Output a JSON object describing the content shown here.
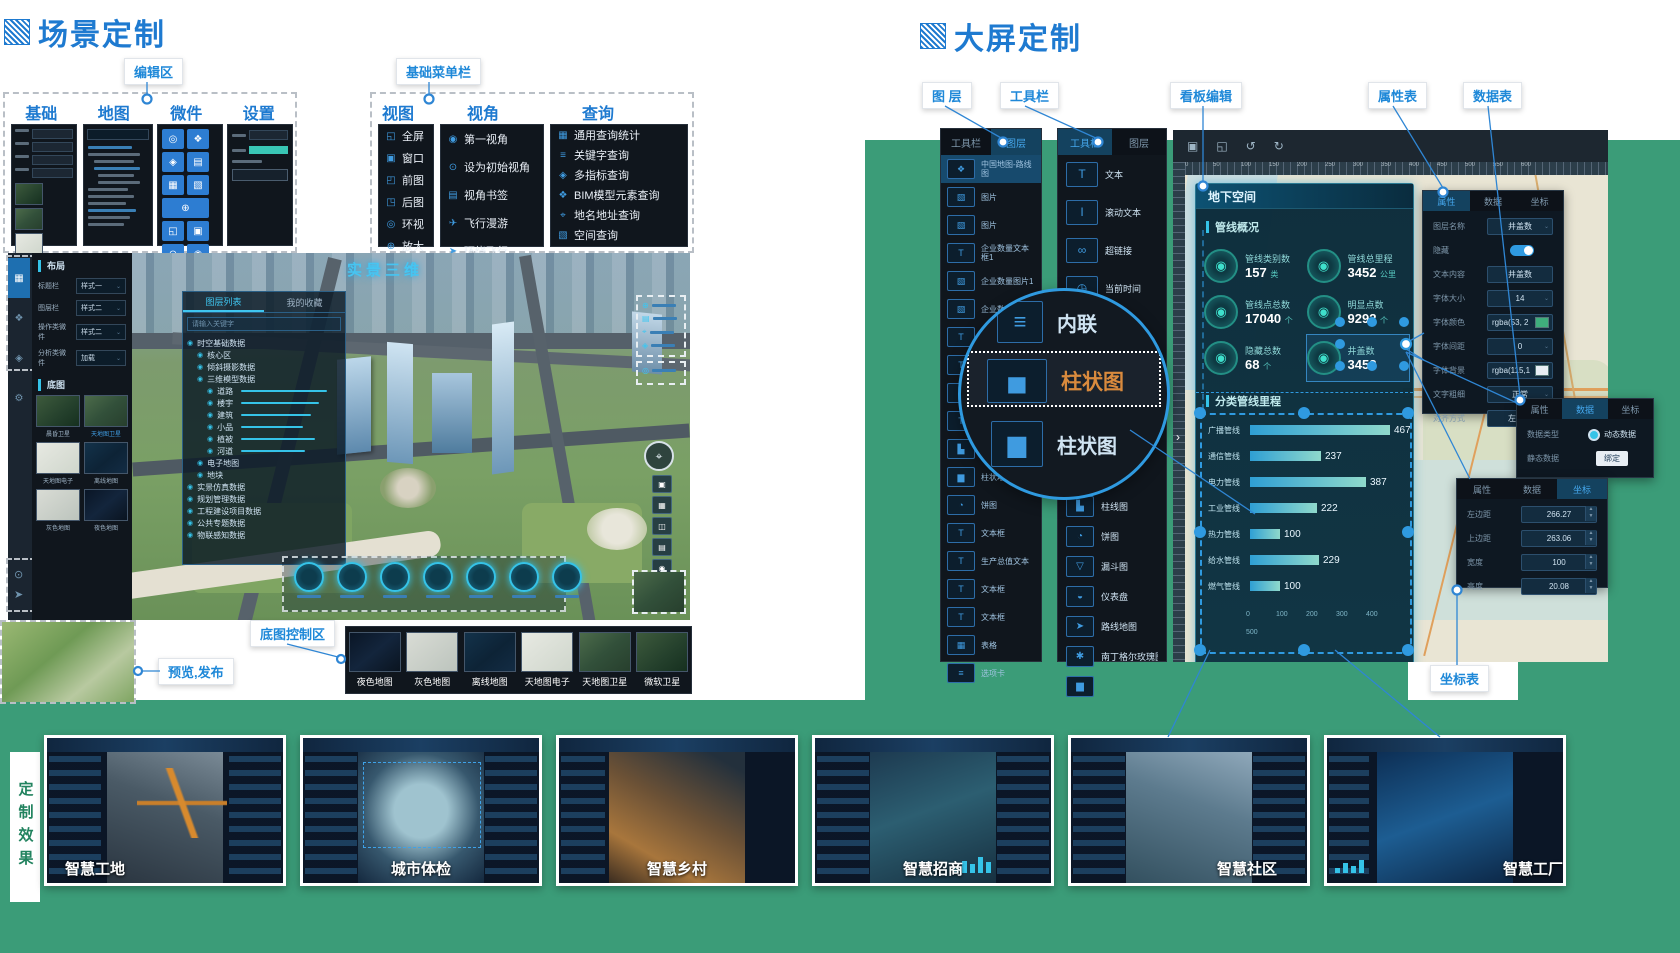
{
  "scene": {
    "title": "场景定制",
    "annotations": {
      "editor": "编辑区",
      "menu": "基础菜单栏",
      "preview": "预览,发布",
      "basemap": "底图控制区"
    },
    "panel_tabs": [
      "基础",
      "地图",
      "微件",
      "设置"
    ],
    "menu_groups": [
      {
        "title": "视图",
        "items": [
          {
            "icon": "fullscreen-icon",
            "label": "全屏"
          },
          {
            "icon": "window-icon",
            "label": "窗口"
          },
          {
            "icon": "prev-view-icon",
            "label": "前图"
          },
          {
            "icon": "next-view-icon",
            "label": "后图"
          },
          {
            "icon": "orbit-icon",
            "label": "环视"
          },
          {
            "icon": "zoom-in-icon",
            "label": "放大"
          },
          {
            "icon": "",
            "label": "⋯"
          }
        ]
      },
      {
        "title": "视角",
        "items": [
          {
            "icon": "first-person-icon",
            "label": "第一视角"
          },
          {
            "icon": "initial-view-icon",
            "label": "设为初始视角"
          },
          {
            "icon": "bookmark-icon",
            "label": "视角书签"
          },
          {
            "icon": "flight-roam-icon",
            "label": "飞行漫游"
          },
          {
            "icon": "orbit-flight-icon",
            "label": "环绕飞行"
          }
        ]
      },
      {
        "title": "查询",
        "items": [
          {
            "icon": "stats-query-icon",
            "label": "通用查询统计"
          },
          {
            "icon": "keyword-query-icon",
            "label": "关键字查询"
          },
          {
            "icon": "multi-indicator-icon",
            "label": "多指标查询"
          },
          {
            "icon": "bim-query-icon",
            "label": "BIM模型元素查询"
          },
          {
            "icon": "address-query-icon",
            "label": "地名地址查询"
          },
          {
            "icon": "spatial-query-icon",
            "label": "空间查询"
          },
          {
            "icon": "",
            "label": "⋯"
          }
        ]
      }
    ],
    "layout_header": "布局",
    "layout_rows": [
      {
        "label": "标题栏",
        "value": "样式一"
      },
      {
        "label": "图层栏",
        "value": "样式二"
      },
      {
        "label": "操作类微件",
        "value": "样式二"
      },
      {
        "label": "分析类微件",
        "value": "加载"
      }
    ],
    "basemap_header": "底图",
    "basemap_thumbs": [
      {
        "label": "晨昏卫星"
      },
      {
        "label": "天地图卫星",
        "active": true
      },
      {
        "label": "天地图电子"
      },
      {
        "label": "离线地图"
      },
      {
        "label": "灰色地图"
      },
      {
        "label": "夜色地图"
      }
    ],
    "tree_tabs": [
      "图层列表",
      "我的收藏"
    ],
    "tree_search_placeholder": "请输入关键字",
    "tree": [
      {
        "lv": 0,
        "label": "时空基础数据"
      },
      {
        "lv": 1,
        "label": "核心区"
      },
      {
        "lv": 1,
        "label": "倾斜摄影数据"
      },
      {
        "lv": 1,
        "label": "三维模型数据"
      },
      {
        "lv": 2,
        "label": "道路",
        "slider": 86
      },
      {
        "lv": 2,
        "label": "楼宇",
        "slider": 78
      },
      {
        "lv": 2,
        "label": "建筑",
        "slider": 70
      },
      {
        "lv": 2,
        "label": "小品",
        "slider": 62
      },
      {
        "lv": 2,
        "label": "植被",
        "slider": 74
      },
      {
        "lv": 2,
        "label": "河道",
        "slider": 64
      },
      {
        "lv": 1,
        "label": "电子地图"
      },
      {
        "lv": 1,
        "label": "地块"
      },
      {
        "lv": 0,
        "label": "实景仿真数据"
      },
      {
        "lv": 0,
        "label": "规划管理数据"
      },
      {
        "lv": 0,
        "label": "工程建设项目数据"
      },
      {
        "lv": 0,
        "label": "公共专题数据"
      },
      {
        "lv": 0,
        "label": "物联感知数据"
      }
    ],
    "watermark": "实景三维",
    "basemap_bar": [
      {
        "label": "夜色地图"
      },
      {
        "label": "灰色地图"
      },
      {
        "label": "离线地图"
      },
      {
        "label": "天地图电子"
      },
      {
        "label": "天地图卫星"
      },
      {
        "label": "微软卫星"
      }
    ]
  },
  "screen": {
    "title": "大屏定制",
    "annotations": {
      "layers": "图 层",
      "toolbar": "工具栏",
      "board": "看板编辑",
      "props": "属性表",
      "data": "数据表",
      "coords": "坐标表"
    },
    "panel_tabs": [
      "工具栏",
      "图层"
    ],
    "layers": [
      {
        "icon": "map-icon",
        "label": "中国地图-路线图",
        "active": true
      },
      {
        "icon": "image-icon",
        "label": "图片"
      },
      {
        "icon": "image-icon",
        "label": "图片"
      },
      {
        "icon": "text-icon",
        "label": "企业数量文本框1"
      },
      {
        "icon": "image-icon",
        "label": "企业数量图片1"
      },
      {
        "icon": "image-icon",
        "label": "企业数量图片2"
      },
      {
        "icon": "text-icon",
        "label": "企业数量文本"
      },
      {
        "icon": "text-icon",
        "label": "企业数量文本框4"
      },
      {
        "icon": "text-icon",
        "label": "企业数量文本"
      },
      {
        "icon": "text-icon",
        "label": "企业数量文本3"
      },
      {
        "icon": "chart-line-icon",
        "label": "生产柱线图"
      },
      {
        "icon": "bars-icon",
        "label": "柱状堆叠图"
      },
      {
        "icon": "pie-icon",
        "label": "饼图"
      },
      {
        "icon": "text-icon",
        "label": "文本框"
      },
      {
        "icon": "text-icon",
        "label": "生产总值文本"
      },
      {
        "icon": "text-icon",
        "label": "文本框"
      },
      {
        "icon": "text-icon",
        "label": "文本框"
      },
      {
        "icon": "table-icon",
        "label": "表格"
      },
      {
        "icon": "tab-card-icon",
        "label": "选项卡"
      }
    ],
    "tools_top": [
      {
        "icon": "text-icon",
        "label": "文本"
      },
      {
        "icon": "scroll-text-icon",
        "label": "滚动文本"
      },
      {
        "icon": "hyperlink-icon",
        "label": "超链接"
      },
      {
        "icon": "time-icon",
        "label": "当前时间"
      },
      {
        "icon": "image-icon",
        "label": "图片"
      },
      {
        "icon": "video-icon",
        "label": "视频"
      }
    ],
    "tools_bottom": [
      {
        "icon": "chart-line-icon",
        "label": "柱线图"
      },
      {
        "icon": "pie-icon",
        "label": "饼图"
      },
      {
        "icon": "funnel-icon",
        "label": "漏斗图"
      },
      {
        "icon": "gauge-icon",
        "label": "仪表盘"
      },
      {
        "icon": "route-map-icon",
        "label": "路线地图"
      },
      {
        "icon": "rose-icon",
        "label": "南丁格尔玫瑰图"
      },
      {
        "icon": "bars-icon",
        "label": ""
      }
    ],
    "magnifier_items": [
      {
        "icon": "list-icon",
        "label": "内联"
      },
      {
        "icon": "bar-chart-icon",
        "label": "柱状图",
        "selected": true
      },
      {
        "icon": "bars-icon",
        "label": "柱状图"
      }
    ],
    "ruler": [
      "0",
      "50",
      "100",
      "150",
      "200",
      "250",
      "300",
      "350",
      "400",
      "450",
      "500",
      "550",
      "600"
    ],
    "dashboard": {
      "title": "地下空间",
      "section1": "管线概况",
      "stats": [
        {
          "label": "管线类别数",
          "value": "157",
          "unit": "类"
        },
        {
          "label": "管线点总数",
          "value": "17040",
          "unit": "个"
        },
        {
          "label": "隐藏总数",
          "value": "68",
          "unit": "个"
        },
        {
          "label": "管线总里程",
          "value": "3452",
          "unit": "公里"
        },
        {
          "label": "明显点数",
          "value": "9292",
          "unit": "个"
        },
        {
          "label": "井盖数",
          "value": "3452",
          "unit": "",
          "selected": true
        }
      ]
    },
    "props": {
      "tabs": [
        "属性",
        "数据",
        "坐标"
      ],
      "active_tab": "属性",
      "rows": [
        {
          "label": "图层名称",
          "value": "井盖数",
          "type": "select"
        },
        {
          "label": "隐藏",
          "value": "",
          "type": "toggle"
        },
        {
          "label": "文本内容",
          "value": "井盖数",
          "type": "input"
        },
        {
          "label": "字体大小",
          "value": "14",
          "type": "select"
        },
        {
          "label": "字体颜色",
          "value": "rgba(53, 2",
          "type": "color",
          "swatch": "#3fae7c"
        },
        {
          "label": "字体间距",
          "value": "0",
          "type": "select"
        },
        {
          "label": "字体背景",
          "value": "rgba(115,1",
          "type": "color",
          "swatch": "#e8eef4"
        },
        {
          "label": "文字粗细",
          "value": "正常",
          "type": "select"
        },
        {
          "label": "对齐方式",
          "value": "左对齐",
          "type": "select"
        }
      ]
    },
    "data_panel": {
      "tabs": [
        "属性",
        "数据",
        "坐标"
      ],
      "active_tab": "数据",
      "rows": [
        {
          "label": "数据类型",
          "value": "动态数据",
          "type": "radio"
        },
        {
          "label": "静态数据",
          "value": "绑定",
          "type": "button"
        }
      ]
    },
    "coords_panel": {
      "tabs": [
        "属性",
        "数据",
        "坐标"
      ],
      "active_tab": "坐标",
      "rows": [
        {
          "label": "左边距",
          "value": "266.27",
          "type": "num"
        },
        {
          "label": "上边距",
          "value": "263.06",
          "type": "num"
        },
        {
          "label": "宽度",
          "value": "100",
          "type": "num"
        },
        {
          "label": "高度",
          "value": "20.08",
          "type": "num"
        }
      ]
    }
  },
  "chart_data": {
    "type": "bar",
    "orientation": "horizontal",
    "title": "分类管线里程",
    "categories": [
      "广播管线",
      "通信管线",
      "电力管线",
      "工业管线",
      "热力管线",
      "给水管线",
      "燃气管线"
    ],
    "values": [
      467,
      237,
      387,
      222,
      100,
      229,
      100
    ],
    "xticks": [
      "0",
      "100",
      "200",
      "300",
      "400",
      "500"
    ],
    "xlim": [
      0,
      500
    ],
    "value_labels_shown": true
  },
  "gallery": {
    "side_label": "定制效果",
    "items": [
      {
        "title": "智慧工地"
      },
      {
        "title": "城市体检"
      },
      {
        "title": "智慧乡村"
      },
      {
        "title": "智慧招商"
      },
      {
        "title": "智慧社区"
      },
      {
        "title": "智慧工厂"
      }
    ]
  }
}
